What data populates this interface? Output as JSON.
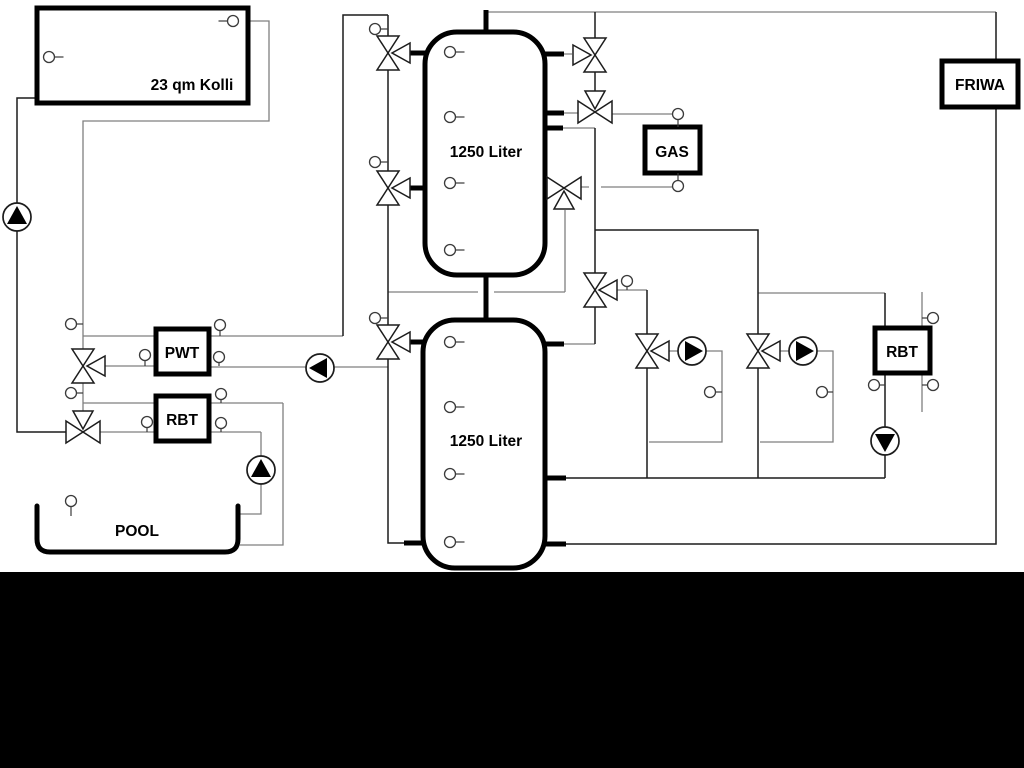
{
  "diagram": {
    "labels": {
      "collector": "23 qm Kolli",
      "tank_top": "1250 Liter",
      "tank_bottom": "1250 Liter",
      "gas": "GAS",
      "friwa": "FRIWA",
      "pwt": "PWT",
      "rbt_left": "RBT",
      "rbt_right": "RBT",
      "pool": "POOL"
    },
    "colors": {
      "pipe_gray": "#7f7f7f",
      "pipe_dark": "#1c1c1c",
      "component_stroke": "#000000",
      "background": "#ffffff",
      "letterbox_bottom": "#000000"
    }
  }
}
